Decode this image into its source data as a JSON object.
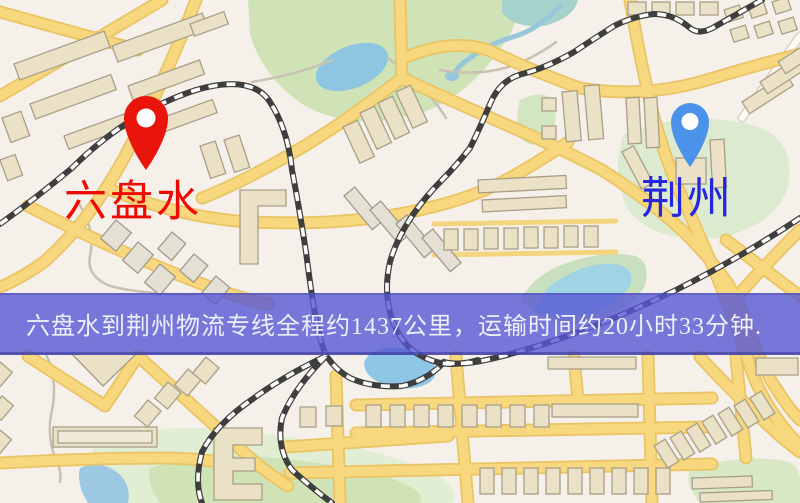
{
  "banner": {
    "text": "六盘水到荆州物流专线全程约1437公里，运输时间约20小时33分钟.",
    "background_color": "#5858d5",
    "text_color": "#edeffa"
  },
  "markers": {
    "origin": {
      "name": "六盘水",
      "label_color": "#ee0903",
      "pin_color": "#e9140b"
    },
    "destination": {
      "name": "荆州",
      "label_color": "#2626de",
      "pin_color": "#4b92ea"
    }
  },
  "map_palette": {
    "background": "#f6f0ea",
    "major_road": "#f8d87e",
    "road_casing": "#eac464",
    "minor_road": "#fdfbf5",
    "park_green": "#cfe3b6",
    "water_blue": "#8ec6e2",
    "building_tan": "#eae1c6",
    "railway_dark": "#3e3e3e"
  }
}
